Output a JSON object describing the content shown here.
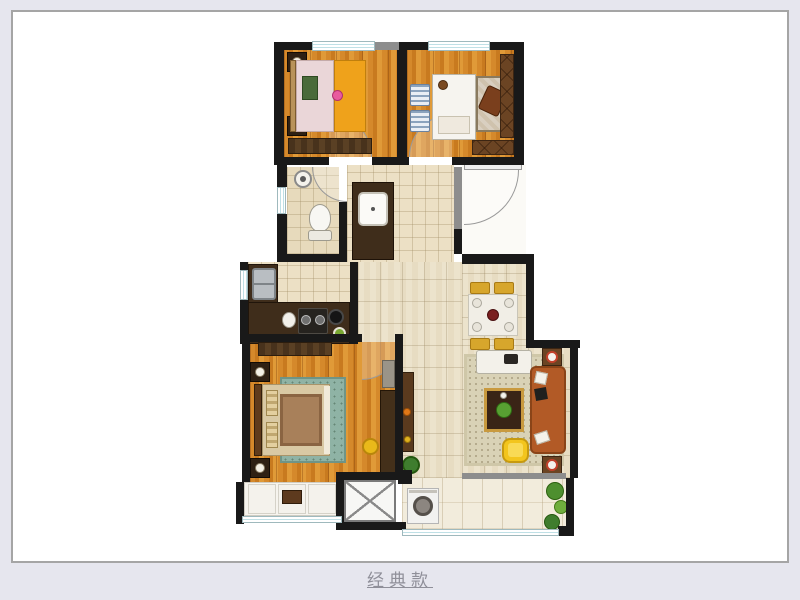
{
  "page": {
    "background_color": "#e6e6ee",
    "panel_background": "#ffffff",
    "panel_border_color": "#a5a5a5"
  },
  "footer": {
    "label": "经典款",
    "text_color": "#8f8f99"
  },
  "floor_plan": {
    "type": "apartment-floor-plan",
    "style": "rendered-top-down",
    "palette": {
      "wall": "#191919",
      "wall_secondary": "#8d8d8d",
      "window_glass": "#bfe0e6",
      "bedroom_wood_floor": "#d5892b",
      "hall_tile": "#ece0c5",
      "corridor_tile": "#ece3cc",
      "balcony_tile": "#f2ecdc",
      "kitchen_counter": "#3f2d1b",
      "sofa": "#b25a26",
      "dining_chair": "#d7a62c",
      "armchair": "#f3c51d",
      "master_rug": "#8fb3a5",
      "bed_blanket_orange": "#efa21b",
      "living_rug": "#d9d2b6"
    },
    "rooms": [
      {
        "name": "bedroom-top-left"
      },
      {
        "name": "study-bedroom-top-right"
      },
      {
        "name": "bathroom"
      },
      {
        "name": "hallway"
      },
      {
        "name": "kitchen"
      },
      {
        "name": "entry"
      },
      {
        "name": "dining-area"
      },
      {
        "name": "living-room"
      },
      {
        "name": "master-bedroom"
      },
      {
        "name": "bay-window"
      },
      {
        "name": "duct-shaft"
      },
      {
        "name": "balcony"
      }
    ]
  }
}
